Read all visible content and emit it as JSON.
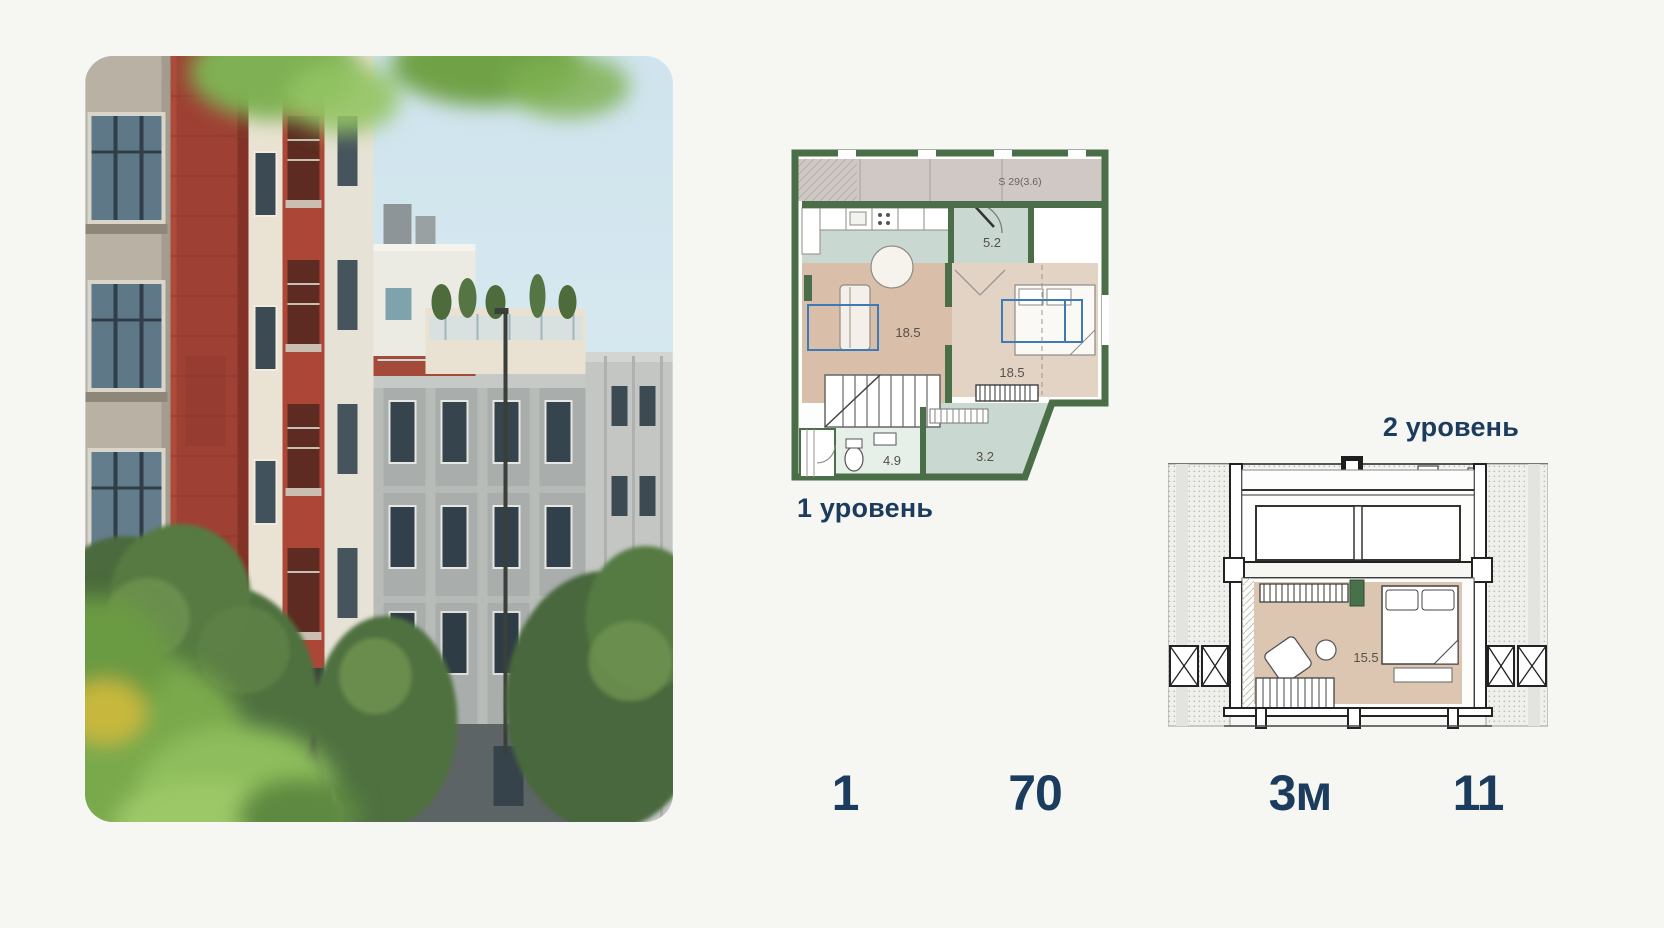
{
  "colors": {
    "background": "#f6f6f3",
    "accent_text": "#1c3c5e",
    "plan_wall_green": "#4a6f48",
    "plan_floor_tan": "#d9bfa9",
    "plan_floor_pale_green": "#c9d8d0",
    "plan_highlight_blue": "#3d7ab8",
    "photo_sky": "#d8e8f0",
    "photo_brick_red": "#9e4134"
  },
  "photo": {
    "description": "Street photo: red brick and beige residential buildings, gray classical facade, trees and blurred green leaves in the foreground"
  },
  "plan_level1": {
    "label": "1 уровень",
    "terrace_area_label": "S 29(3.6)",
    "room_areas": {
      "entry": "5.2",
      "living": "18.5",
      "bedroom": "18.5",
      "bathroom": "4.9",
      "hall": "3.2"
    }
  },
  "plan_level2": {
    "label": "2 уровень",
    "room_areas": {
      "bedroom": "15.5"
    }
  },
  "stats": [
    {
      "value": "1"
    },
    {
      "value": "70"
    },
    {
      "value": "3м"
    },
    {
      "value": "11"
    }
  ]
}
